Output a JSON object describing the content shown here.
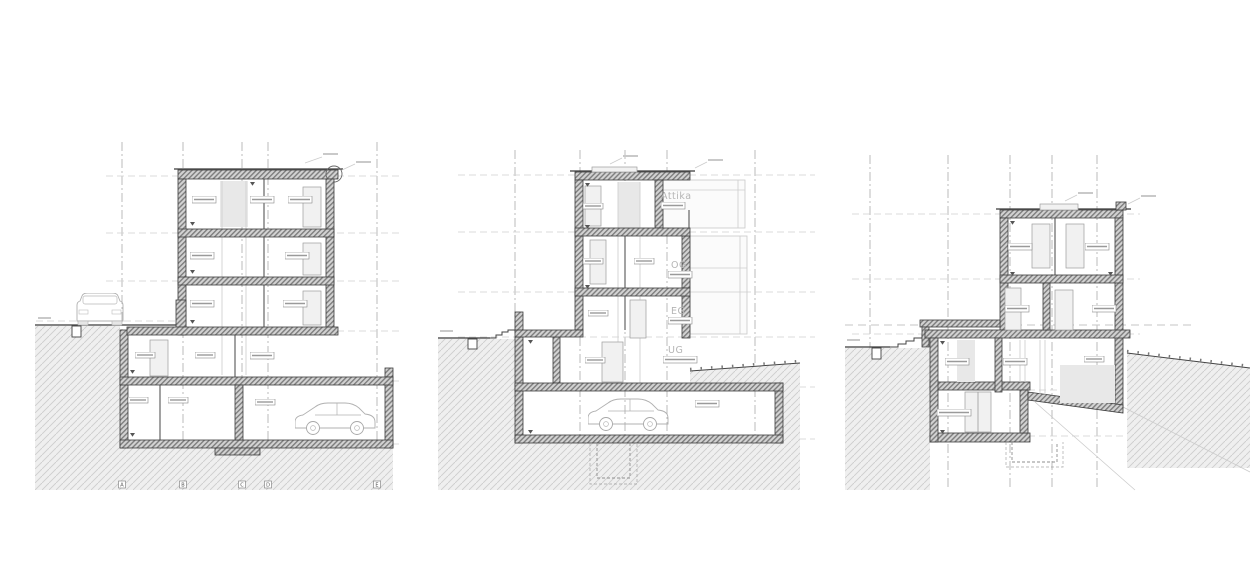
{
  "drawing": {
    "type": "architectural-building-sections",
    "middle_section": {
      "floor_labels": [
        {
          "id": "attika",
          "label": "Attika"
        },
        {
          "id": "og",
          "label": "OG"
        },
        {
          "id": "eg",
          "label": "EG"
        },
        {
          "id": "ug",
          "label": "UG"
        }
      ]
    },
    "left_section": {
      "grid_letters": [
        "A",
        "B",
        "C",
        "D",
        "E"
      ]
    },
    "colors": {
      "line_dark": "#3a3a3a",
      "wall_hatch": "#7d7d7d",
      "ground_hatch": "#cdcdcd",
      "floor_label_gray": "#b5b5b5",
      "background": "#ffffff"
    }
  }
}
